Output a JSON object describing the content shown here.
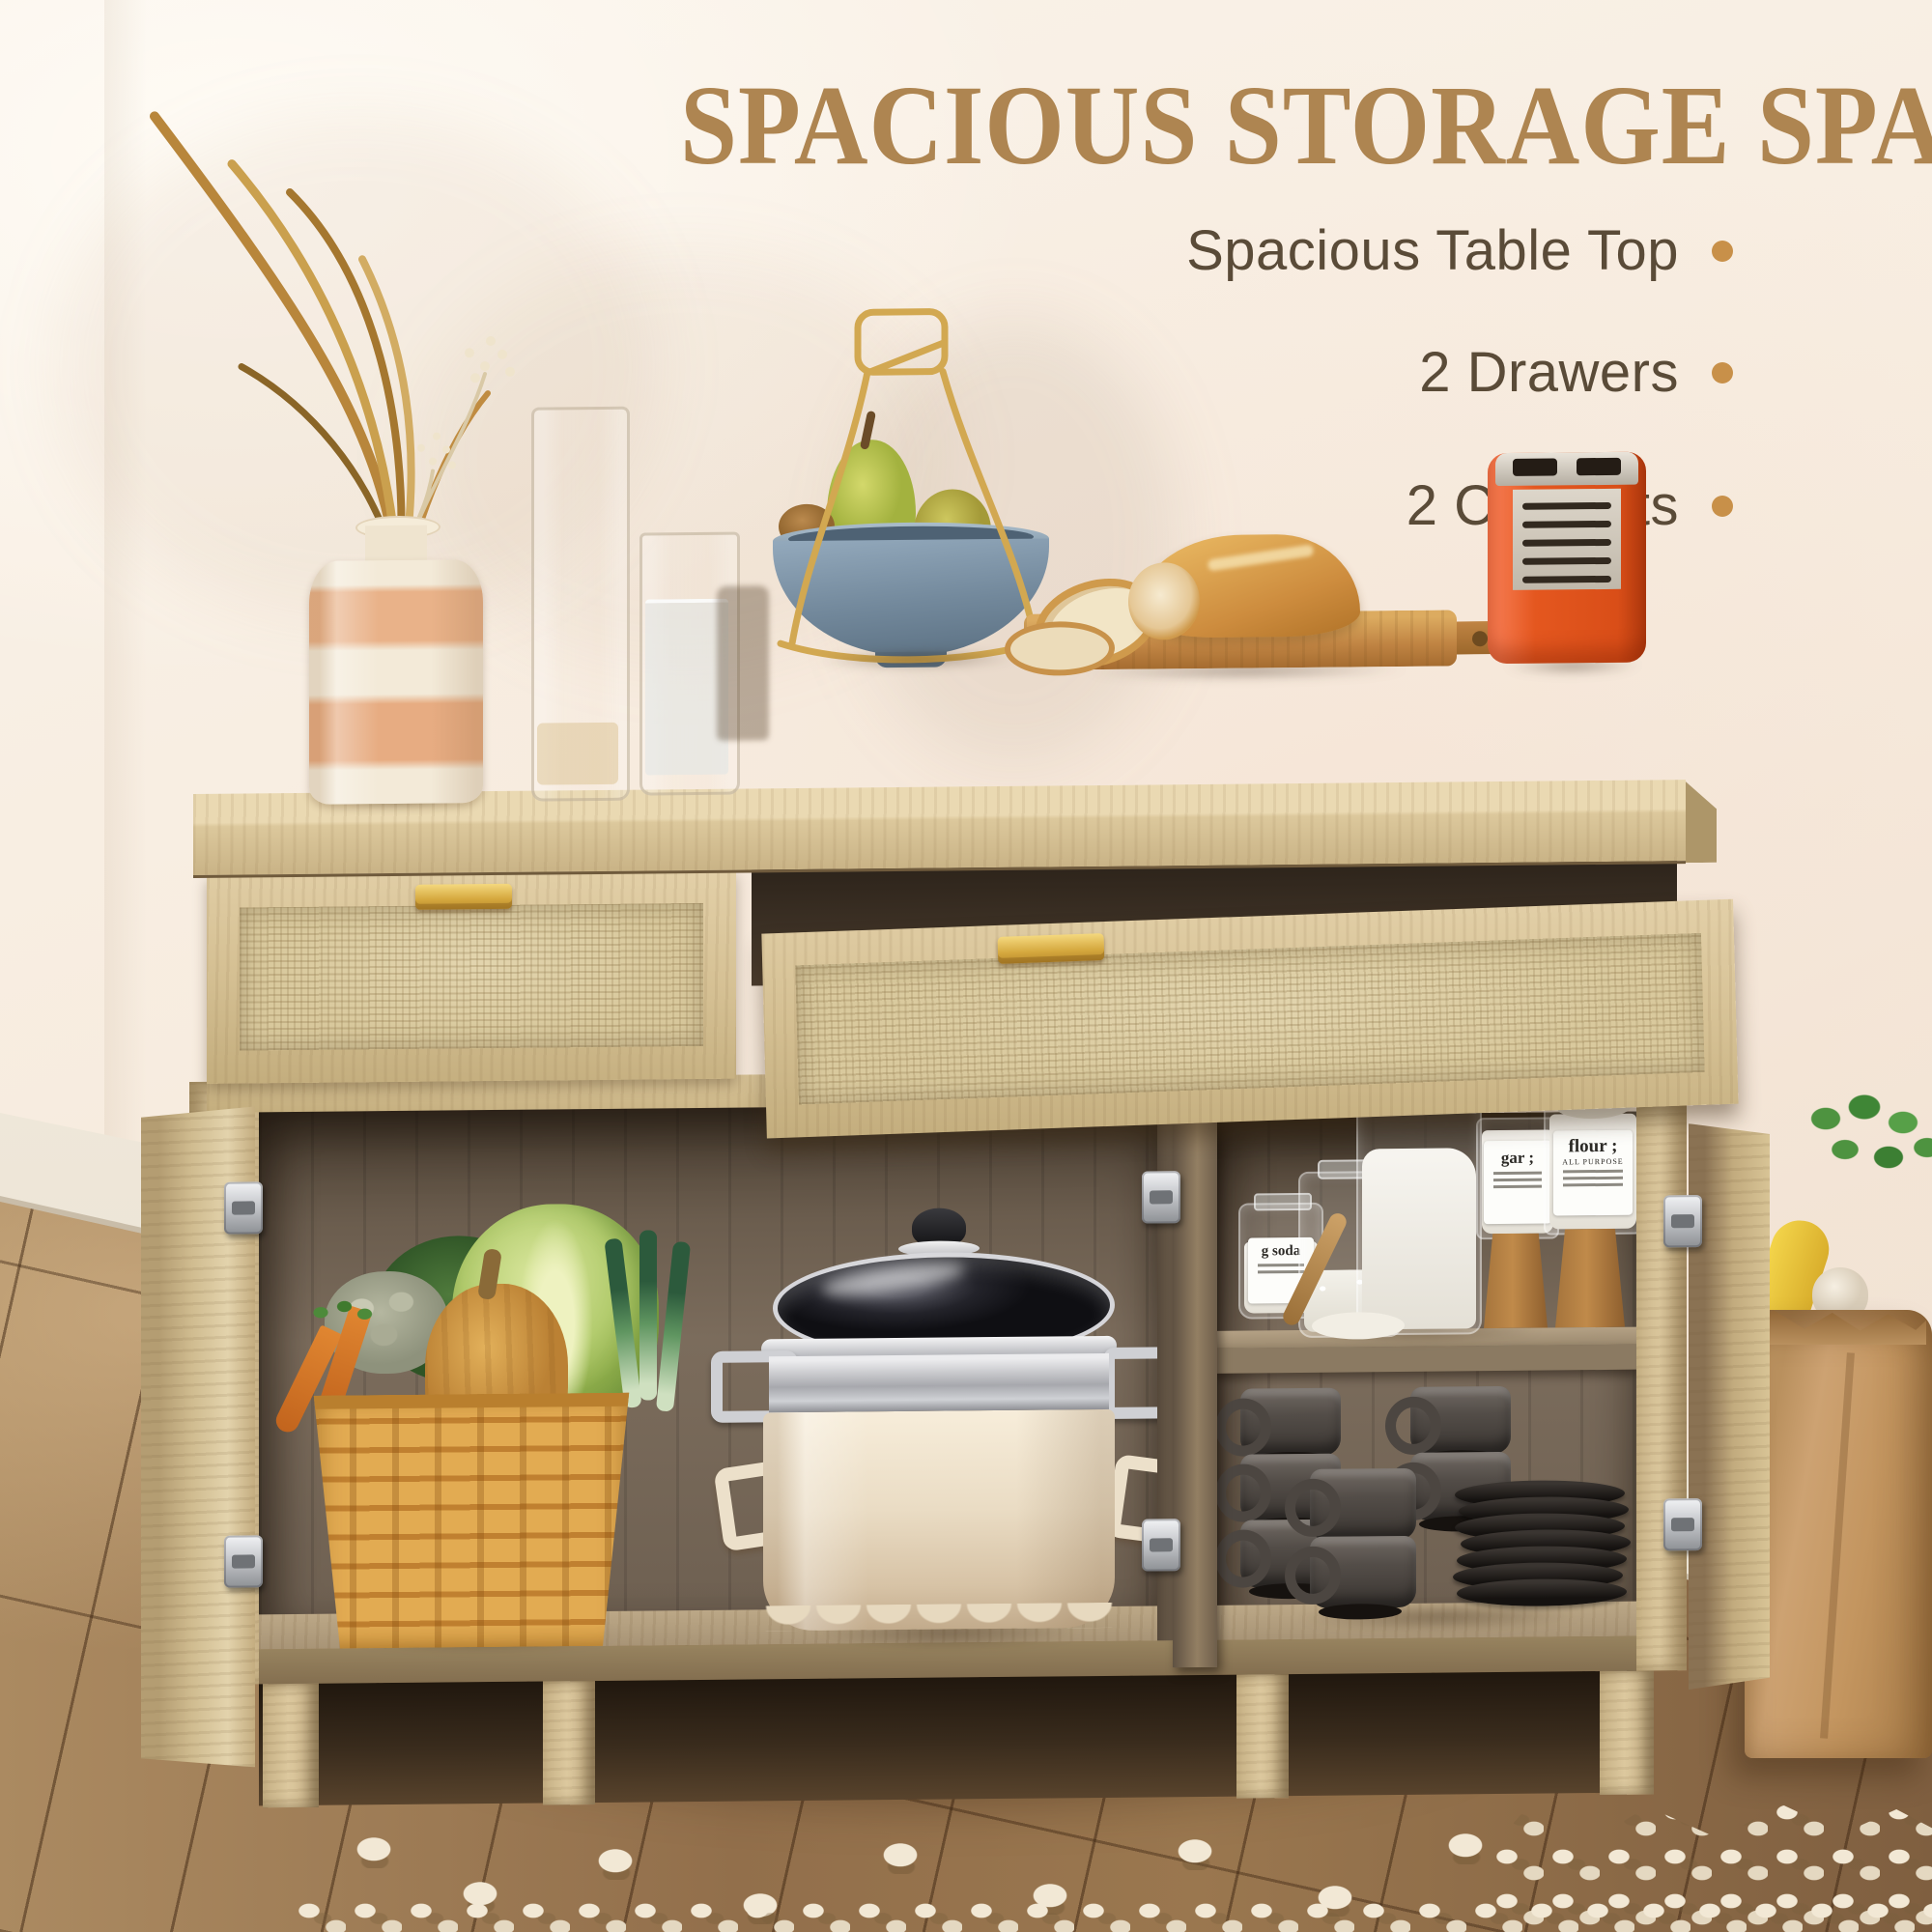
{
  "title": {
    "text": "SPACIOUS STORAGE SPACE"
  },
  "features": [
    {
      "label": "Spacious Table Top"
    },
    {
      "label": "2 Drawers"
    },
    {
      "label": "2 Cabinets"
    }
  ],
  "pantry_jars": {
    "soda_label": "g soda",
    "sugar_label": "gar ;",
    "flour_label": "flour ;",
    "flour_sublabel": "ALL PURPOSE"
  },
  "palette": {
    "background_cream": "#f6ecdf",
    "heading_gold": "#ae8551",
    "feature_text_brown": "#5a4b38",
    "bullet_gold": "#c89049",
    "oak_wood": "#d4bf92",
    "rattan": "#d9c99d",
    "interior_dark_wood": "#6e6051",
    "toaster_orange": "#e4571f",
    "bowl_slate_blue": "#7e94a6",
    "floor_brown": "#926f4b"
  },
  "scene_objects": [
    "sideboard with rattan drawer fronts",
    "open drawer",
    "closed drawer",
    "open left cabinet",
    "open right cabinet",
    "striped ceramic vase with dried grass",
    "tall glass vase",
    "glass of water",
    "blue fruit bowl with pears on gold wire stand",
    "cutting board with bread loaf and slices",
    "retro orange toaster",
    "wicker basket of vegetables",
    "cream cooking pot with glass lid",
    "pantry jars",
    "stacked coffee mugs",
    "stacked saucers",
    "paper grocery bag with vegetables",
    "wooden floor",
    "white tufted rug"
  ]
}
